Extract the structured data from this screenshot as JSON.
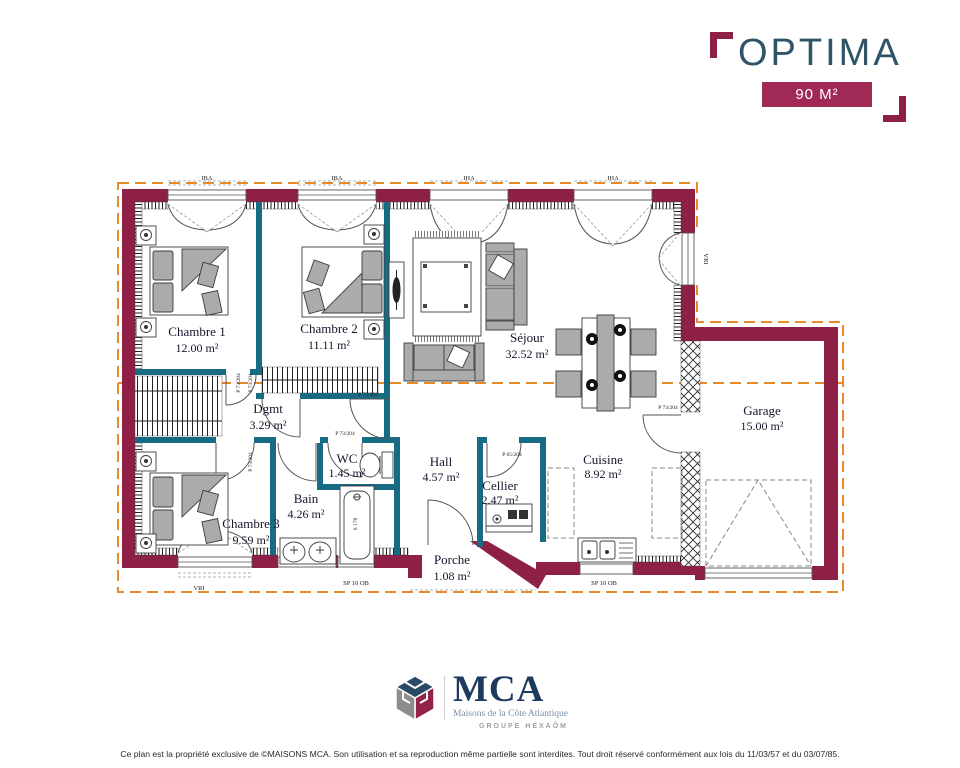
{
  "header": {
    "plan_name": "OPTIMA",
    "area_badge": "90 M²"
  },
  "rooms": {
    "chambre1": {
      "name": "Chambre 1",
      "area": "12.00 m²"
    },
    "chambre2": {
      "name": "Chambre 2",
      "area": "11.11 m²"
    },
    "sejour": {
      "name": "Séjour",
      "area": "32.52 m²"
    },
    "dgmt": {
      "name": "Dgmt",
      "area": "3.29 m²"
    },
    "wc": {
      "name": "WC",
      "area": "1.45 m²"
    },
    "bain": {
      "name": "Bain",
      "area": "4.26 m²"
    },
    "chambre3": {
      "name": "Chambre 3",
      "area": "9.59 m²"
    },
    "hall": {
      "name": "Hall",
      "area": "4.57 m²"
    },
    "cellier": {
      "name": "Cellier",
      "area": "2.47 m²"
    },
    "cuisine": {
      "name": "Cuisine",
      "area": "8.92 m²"
    },
    "porche": {
      "name": "Porche",
      "area": "1.08 m²"
    },
    "garage": {
      "name": "Garage",
      "area": "15.00 m²"
    }
  },
  "annotations": {
    "door_label": "P 73/204",
    "cellier_door_label": "P 65/204",
    "window_small": "IBA",
    "window_bay": "IHA",
    "window_roller": "VRI",
    "sill_label": "SP 10 OB",
    "tub_label": "S 170"
  },
  "footer": {
    "logo_text": "MCA",
    "logo_subtitle": "Maisons de la Côte Atlantique",
    "logo_group": "GROUPE HEXAÔM",
    "disclaimer": "Ce plan est la propriété exclusive de ©MAISONS MCA. Son utilisation et sa reproduction même partielle sont interdites. Tout droit réservé conformément aux lois du 11/03/57 et du 03/07/85."
  },
  "colors": {
    "wall_exterior": "#8E2048",
    "wall_interior": "#176C84",
    "roof_outline": "#E8892E",
    "brand_navy": "#2F5468",
    "badge": "#A12956"
  }
}
